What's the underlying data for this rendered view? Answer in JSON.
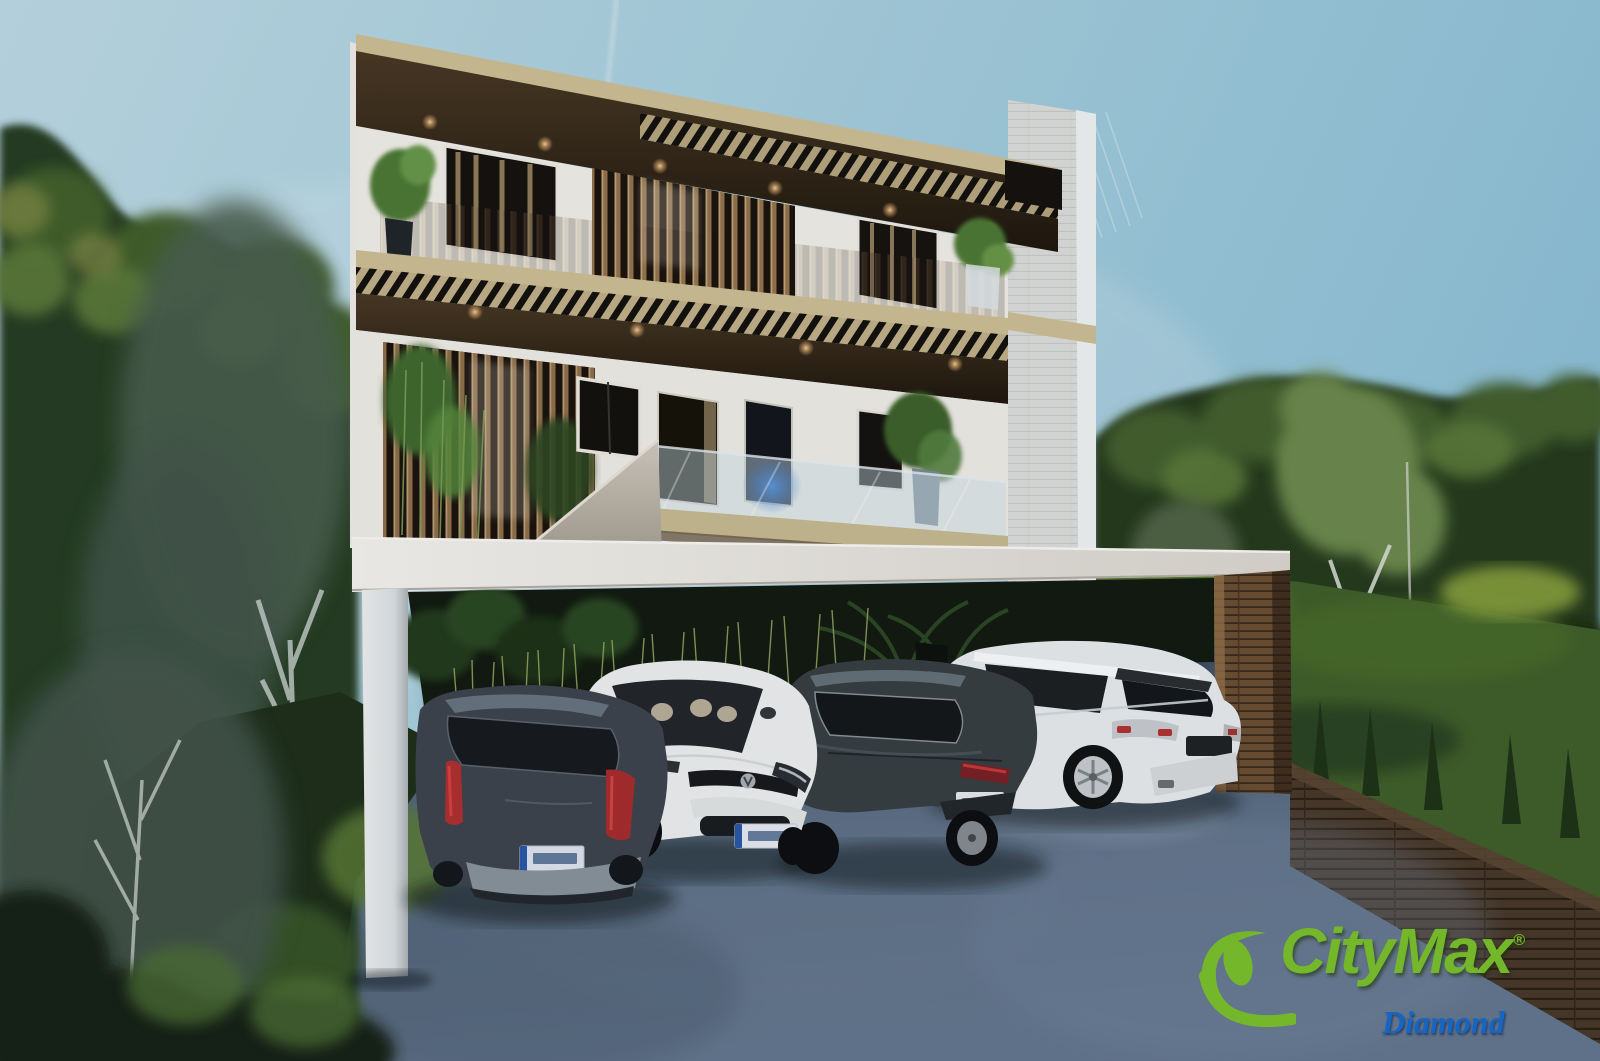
{
  "image": {
    "kind": "3D architectural exterior rendering (real-estate listing photo)",
    "subject": "Modern three-story white residence with wood-slat screens, cantilevered white carport and four parked cars at dusk",
    "setting": "Dense green trees flank both sides, lawn with small pines and a wooden retaining wall on the right, blue-gray concrete driveway in the foreground, pale blue sky with a faint contrail"
  },
  "watermark": {
    "brand": "CityMax",
    "registered": "®",
    "sub_brand": "Diamond"
  },
  "building": {
    "floors_visible": 3,
    "features": [
      "dark wood roof fascia with recessed warm lights",
      "vertical wood slat privacy screens",
      "louvered pergola band between floors",
      "glass balcony balustrade with blue interior glow",
      "concrete stair wedge",
      "white stone side wall",
      "white cantilevered carport slab on white column and wood-clad pillar",
      "tropical planting and tall grasses under the carport"
    ]
  },
  "vehicles": [
    {
      "slot": 1,
      "type": "hatchback",
      "color": "dark gray",
      "view": "rear",
      "plate": "white EU plate, characters illegible"
    },
    {
      "slot": 2,
      "type": "coupe",
      "color": "white",
      "view": "front",
      "plate": "white EU plate, characters illegible"
    },
    {
      "slot": 3,
      "type": "fastback sedan",
      "color": "dark charcoal",
      "view": "rear",
      "plate": "white plate, characters illegible"
    },
    {
      "slot": 4,
      "type": "SUV",
      "color": "white",
      "view": "rear",
      "plate": "dark recess, illegible"
    }
  ],
  "palette": {
    "sky_left": "#bcdae6",
    "sky_right": "#8fc2d8",
    "wall_white": "#f1efe9",
    "roof_khaki": "#cfc196",
    "soffit_wood": "#3f3020",
    "slat_wood": "#9a7850",
    "concrete_slab": "#ece9e2",
    "driveway": "#5b6e84",
    "lawn_green": "#45652c",
    "tree_dark": "#263b1f",
    "tree_light": "#5d7c3a",
    "logo_green": "#74b72b",
    "diamond_blue": "#1566c4"
  }
}
